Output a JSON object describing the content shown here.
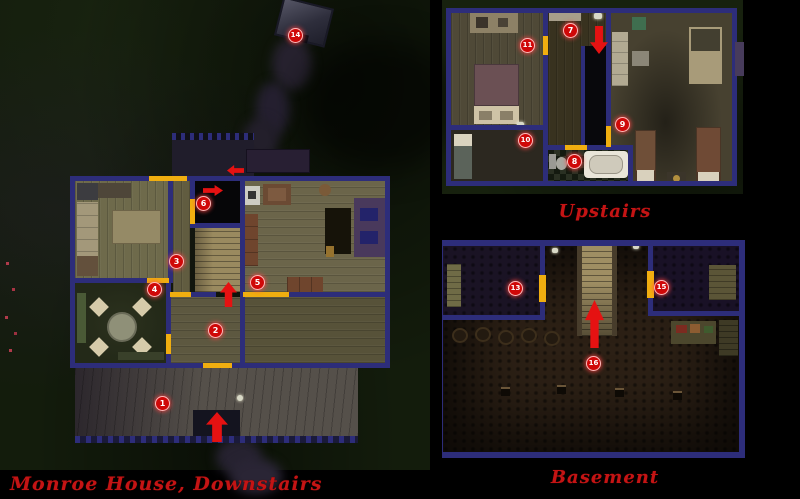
{
  "colors": {
    "wall": "#2d2d7a",
    "door": "#f0ae10",
    "marker": "#cf0808",
    "arrow": "#e51212",
    "caption": "#c41414"
  },
  "floors": [
    {
      "id": "downstairs",
      "caption": "Monroe House, Downstairs",
      "markers": [
        {
          "n": "1",
          "x": 163,
          "y": 404
        },
        {
          "n": "2",
          "x": 216,
          "y": 331
        },
        {
          "n": "3",
          "x": 177,
          "y": 262
        },
        {
          "n": "4",
          "x": 155,
          "y": 290
        },
        {
          "n": "5",
          "x": 258,
          "y": 283
        },
        {
          "n": "6",
          "x": 204,
          "y": 204
        },
        {
          "n": "14",
          "x": 296,
          "y": 36
        }
      ],
      "arrows": [
        {
          "dir": "left",
          "x": 227,
          "y": 165,
          "w": 17,
          "h": 11
        },
        {
          "dir": "right",
          "x": 203,
          "y": 185,
          "w": 20,
          "h": 11
        },
        {
          "dir": "up",
          "x": 220,
          "y": 282,
          "w": 17,
          "h": 25
        },
        {
          "dir": "up",
          "x": 206,
          "y": 412,
          "w": 22,
          "h": 30
        }
      ]
    },
    {
      "id": "upstairs",
      "caption": "Upstairs",
      "markers": [
        {
          "n": "7",
          "x": 571,
          "y": 31
        },
        {
          "n": "8",
          "x": 575,
          "y": 162
        },
        {
          "n": "9",
          "x": 623,
          "y": 125
        },
        {
          "n": "10",
          "x": 526,
          "y": 141
        },
        {
          "n": "11",
          "x": 528,
          "y": 46
        }
      ],
      "arrows": [
        {
          "dir": "down",
          "x": 590,
          "y": 26,
          "w": 18,
          "h": 28
        }
      ]
    },
    {
      "id": "basement",
      "caption": "Basement",
      "markers": [
        {
          "n": "13",
          "x": 516,
          "y": 289
        },
        {
          "n": "15",
          "x": 662,
          "y": 288
        },
        {
          "n": "16",
          "x": 594,
          "y": 364
        }
      ],
      "arrows": [
        {
          "dir": "up",
          "x": 585,
          "y": 300,
          "w": 19,
          "h": 48
        }
      ]
    }
  ]
}
